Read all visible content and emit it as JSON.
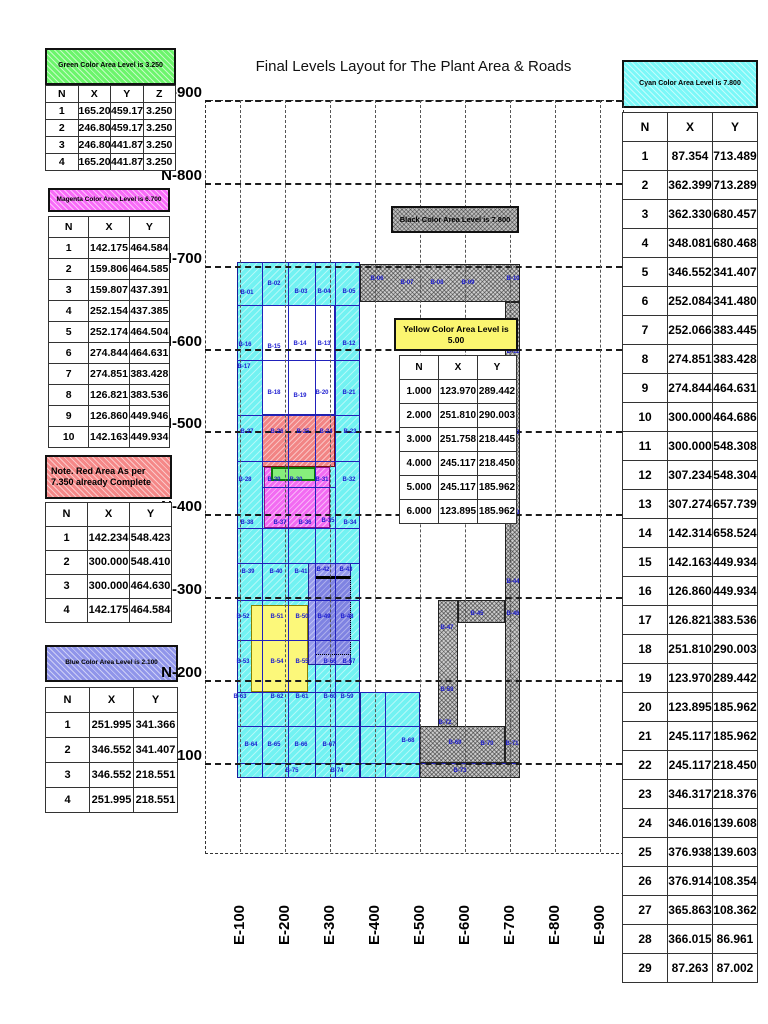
{
  "title": "Final Levels Layout for The Plant Area & Roads",
  "colors": {
    "cyan": "#7bf8f8",
    "green": "#6cf56c",
    "magenta": "#f86bf8",
    "red": "#f58888",
    "blue": "#9095ea",
    "yellow": "#fbf670",
    "hatch_gray": "#cccccc",
    "figure_line_blue": "#2121bb"
  },
  "left_panel": {
    "green": {
      "header": "Green Color Area Level is 3.250",
      "columns": [
        "N",
        "X",
        "Y",
        "Z"
      ],
      "rows": [
        [
          "1",
          "165.201",
          "459.177",
          "3.250"
        ],
        [
          "2",
          "246.802",
          "459.178",
          "3.250"
        ],
        [
          "3",
          "246.801",
          "441.878",
          "3.250"
        ],
        [
          "4",
          "165.202",
          "441.876",
          "3.250"
        ]
      ]
    },
    "magenta": {
      "header": "Magenta Color Area Level is 6.700",
      "columns": [
        "N",
        "X",
        "Y"
      ],
      "rows": [
        [
          "1",
          "142.175",
          "464.584"
        ],
        [
          "2",
          "159.806",
          "464.585"
        ],
        [
          "3",
          "159.807",
          "437.391"
        ],
        [
          "4",
          "252.154",
          "437.385"
        ],
        [
          "5",
          "252.174",
          "464.504"
        ],
        [
          "6",
          "274.844",
          "464.631"
        ],
        [
          "7",
          "274.851",
          "383.428"
        ],
        [
          "8",
          "126.821",
          "383.536"
        ],
        [
          "9",
          "126.860",
          "449.946"
        ],
        [
          "10",
          "142.163",
          "449.934"
        ]
      ]
    },
    "red": {
      "header_line1": "Note. Red Area As per",
      "header_line2": "7.350 already Complete",
      "columns": [
        "N",
        "X",
        "Y"
      ],
      "rows": [
        [
          "1",
          "142.234",
          "548.423"
        ],
        [
          "2",
          "300.000",
          "548.410"
        ],
        [
          "3",
          "300.000",
          "464.630"
        ],
        [
          "4",
          "142.175",
          "464.584"
        ]
      ]
    },
    "blue": {
      "header": "Blue Color Area Level is 2.100",
      "columns": [
        "N",
        "X",
        "Y"
      ],
      "rows": [
        [
          "1",
          "251.995",
          "341.366"
        ],
        [
          "2",
          "346.552",
          "341.407"
        ],
        [
          "3",
          "346.552",
          "218.551"
        ],
        [
          "4",
          "251.995",
          "218.551"
        ]
      ]
    }
  },
  "right_panel": {
    "cyan": {
      "header": "Cyan Color Area Level is 7.800",
      "columns": [
        "N",
        "X",
        "Y"
      ],
      "rows": [
        [
          "1",
          "87.354",
          "713.489"
        ],
        [
          "2",
          "362.399",
          "713.289"
        ],
        [
          "3",
          "362.330",
          "680.457"
        ],
        [
          "4",
          "348.081",
          "680.468"
        ],
        [
          "5",
          "346.552",
          "341.407"
        ],
        [
          "6",
          "252.084",
          "341.480"
        ],
        [
          "7",
          "252.066",
          "383.445"
        ],
        [
          "8",
          "274.851",
          "383.428"
        ],
        [
          "9",
          "274.844",
          "464.631"
        ],
        [
          "10",
          "300.000",
          "464.686"
        ],
        [
          "11",
          "300.000",
          "548.308"
        ],
        [
          "12",
          "307.234",
          "548.304"
        ],
        [
          "13",
          "307.274",
          "657.739"
        ],
        [
          "14",
          "142.314",
          "658.524"
        ],
        [
          "15",
          "142.163",
          "449.934"
        ],
        [
          "16",
          "126.860",
          "449.934"
        ],
        [
          "17",
          "126.821",
          "383.536"
        ],
        [
          "18",
          "251.810",
          "290.003"
        ],
        [
          "19",
          "123.970",
          "289.442"
        ],
        [
          "20",
          "123.895",
          "185.962"
        ],
        [
          "21",
          "245.117",
          "185.962"
        ],
        [
          "22",
          "245.117",
          "218.450"
        ],
        [
          "23",
          "346.317",
          "218.376"
        ],
        [
          "24",
          "346.016",
          "139.608"
        ],
        [
          "25",
          "376.938",
          "139.603"
        ],
        [
          "26",
          "376.914",
          "108.354"
        ],
        [
          "27",
          "365.863",
          "108.362"
        ],
        [
          "28",
          "366.015",
          "86.961"
        ],
        [
          "29",
          "87.263",
          "87.002"
        ]
      ]
    }
  },
  "plot": {
    "black_label": "Black Color Area Level is 7.800",
    "yellow_legend": {
      "header": "Yellow Color Area Level is 5.00",
      "columns": [
        "N",
        "X",
        "Y"
      ],
      "rows": [
        [
          "1.000",
          "123.970",
          "289.442"
        ],
        [
          "2.000",
          "251.810",
          "290.003"
        ],
        [
          "3.000",
          "251.758",
          "218.445"
        ],
        [
          "4.000",
          "245.117",
          "218.450"
        ],
        [
          "5.000",
          "245.117",
          "185.962"
        ],
        [
          "6.000",
          "123.895",
          "185.962"
        ]
      ]
    },
    "n_lines": [
      {
        "label": "N-900",
        "y": 100
      },
      {
        "label": "N-800",
        "y": 183
      },
      {
        "label": "N-700",
        "y": 266
      },
      {
        "label": "N-600",
        "y": 349
      },
      {
        "label": "N-500",
        "y": 431
      },
      {
        "label": "N-400",
        "y": 514
      },
      {
        "label": "N-300",
        "y": 597
      },
      {
        "label": "N-200",
        "y": 680
      },
      {
        "label": "N-100",
        "y": 763
      }
    ],
    "e_lines": [
      {
        "label": "E-100",
        "x": 240
      },
      {
        "label": "E-200",
        "x": 285
      },
      {
        "label": "E-300",
        "x": 330
      },
      {
        "label": "E-400",
        "x": 375
      },
      {
        "label": "E-500",
        "x": 420
      },
      {
        "label": "E-600",
        "x": 465
      },
      {
        "label": "E-700",
        "x": 510
      },
      {
        "label": "E-800",
        "x": 555
      },
      {
        "label": "E-900",
        "x": 600
      }
    ]
  },
  "figure": {
    "regions": [
      {
        "name": "cyan-main",
        "fill": "cyan",
        "x": 237,
        "y": 262,
        "w": 123,
        "h": 516
      },
      {
        "name": "cyan-bottom-extension",
        "fill": "cyan",
        "x": 360,
        "y": 692,
        "w": 60,
        "h": 86
      },
      {
        "name": "white-interior",
        "fill": "white",
        "x": 262,
        "y": 305,
        "w": 73,
        "h": 110
      },
      {
        "name": "red-area",
        "fill": "red",
        "x": 262,
        "y": 415,
        "w": 73,
        "h": 52
      },
      {
        "name": "magenta-area",
        "fill": "magenta",
        "x": 264,
        "y": 467,
        "w": 66,
        "h": 61
      },
      {
        "name": "green-area",
        "fill": "green",
        "x": 271,
        "y": 467,
        "w": 45,
        "h": 14
      },
      {
        "name": "yellow-area",
        "fill": "yellow",
        "x": 251,
        "y": 605,
        "w": 57,
        "h": 87
      },
      {
        "name": "blue-area",
        "fill": "blue",
        "x": 308,
        "y": 563,
        "w": 43,
        "h": 102
      },
      {
        "name": "blue-inner-box",
        "fill": "blueinner",
        "x": 315,
        "y": 576,
        "w": 36,
        "h": 79
      },
      {
        "name": "hatch-top-band",
        "fill": "hatch",
        "x": 360,
        "y": 264,
        "w": 160,
        "h": 38
      },
      {
        "name": "hatch-right-strip",
        "fill": "hatch",
        "x": 505,
        "y": 302,
        "w": 15,
        "h": 461
      },
      {
        "name": "hatch-mid-strip",
        "fill": "hatch",
        "x": 438,
        "y": 600,
        "w": 20,
        "h": 163
      },
      {
        "name": "hatch-connector",
        "fill": "hatch",
        "x": 458,
        "y": 600,
        "w": 47,
        "h": 23
      },
      {
        "name": "hatch-bottom-cells",
        "fill": "hatch",
        "x": 420,
        "y": 726,
        "w": 85,
        "h": 37
      },
      {
        "name": "hatch-bottom-strip",
        "fill": "hatch",
        "x": 420,
        "y": 763,
        "w": 100,
        "h": 15
      }
    ],
    "vlines": [
      {
        "x": 262,
        "y": 262,
        "len": 516
      },
      {
        "x": 288,
        "y": 262,
        "len": 516
      },
      {
        "x": 315,
        "y": 262,
        "len": 516
      },
      {
        "x": 335,
        "y": 262,
        "len": 516
      },
      {
        "x": 385,
        "y": 692,
        "len": 86
      }
    ],
    "hlines": [
      {
        "y": 305,
        "x": 237,
        "len": 123
      },
      {
        "y": 360,
        "x": 237,
        "len": 123
      },
      {
        "y": 415,
        "x": 237,
        "len": 123
      },
      {
        "y": 461,
        "x": 237,
        "len": 123
      },
      {
        "y": 487,
        "x": 262,
        "len": 73
      },
      {
        "y": 528,
        "x": 237,
        "len": 123
      },
      {
        "y": 563,
        "x": 237,
        "len": 123
      },
      {
        "y": 600,
        "x": 237,
        "len": 123
      },
      {
        "y": 640,
        "x": 237,
        "len": 123
      },
      {
        "y": 692,
        "x": 237,
        "len": 183
      },
      {
        "y": 726,
        "x": 237,
        "len": 183
      },
      {
        "y": 763,
        "x": 237,
        "len": 283
      }
    ],
    "labels": [
      {
        "t": "B-01",
        "x": 247,
        "y": 293
      },
      {
        "t": "B-02",
        "x": 274,
        "y": 284
      },
      {
        "t": "B-03",
        "x": 301,
        "y": 292
      },
      {
        "t": "B-04",
        "x": 324,
        "y": 292
      },
      {
        "t": "B-05",
        "x": 349,
        "y": 292
      },
      {
        "t": "B-06",
        "x": 377,
        "y": 279
      },
      {
        "t": "B-07",
        "x": 407,
        "y": 283
      },
      {
        "t": "B-08",
        "x": 437,
        "y": 283
      },
      {
        "t": "B-09",
        "x": 468,
        "y": 283
      },
      {
        "t": "B-10",
        "x": 513,
        "y": 279
      },
      {
        "t": "B-11",
        "x": 513,
        "y": 352
      },
      {
        "t": "B-12",
        "x": 349,
        "y": 344
      },
      {
        "t": "B-13",
        "x": 324,
        "y": 344
      },
      {
        "t": "B-14",
        "x": 300,
        "y": 344
      },
      {
        "t": "B-15",
        "x": 274,
        "y": 347
      },
      {
        "t": "B-16",
        "x": 245,
        "y": 345
      },
      {
        "t": "B-17",
        "x": 244,
        "y": 367
      },
      {
        "t": "B-18",
        "x": 274,
        "y": 393
      },
      {
        "t": "B-19",
        "x": 300,
        "y": 396
      },
      {
        "t": "B-20",
        "x": 322,
        "y": 393
      },
      {
        "t": "B-21",
        "x": 349,
        "y": 393
      },
      {
        "t": "B-22",
        "x": 513,
        "y": 433
      },
      {
        "t": "B-23",
        "x": 350,
        "y": 432
      },
      {
        "t": "B-24",
        "x": 326,
        "y": 432
      },
      {
        "t": "B-25",
        "x": 303,
        "y": 432
      },
      {
        "t": "B-26",
        "x": 277,
        "y": 432
      },
      {
        "t": "B-27",
        "x": 247,
        "y": 432
      },
      {
        "t": "B-28",
        "x": 245,
        "y": 480
      },
      {
        "t": "B-29",
        "x": 274,
        "y": 480
      },
      {
        "t": "B-30",
        "x": 296,
        "y": 480
      },
      {
        "t": "B-31",
        "x": 322,
        "y": 480
      },
      {
        "t": "B-32",
        "x": 349,
        "y": 480
      },
      {
        "t": "B-33",
        "x": 513,
        "y": 513
      },
      {
        "t": "B-34",
        "x": 350,
        "y": 523
      },
      {
        "t": "B-35",
        "x": 328,
        "y": 521
      },
      {
        "t": "B-36",
        "x": 305,
        "y": 523
      },
      {
        "t": "B-37",
        "x": 280,
        "y": 523
      },
      {
        "t": "B-38",
        "x": 247,
        "y": 523
      },
      {
        "t": "B-39",
        "x": 248,
        "y": 572
      },
      {
        "t": "B-40",
        "x": 276,
        "y": 572
      },
      {
        "t": "B-41",
        "x": 301,
        "y": 572
      },
      {
        "t": "B-42",
        "x": 323,
        "y": 570
      },
      {
        "t": "B-43",
        "x": 346,
        "y": 570
      },
      {
        "t": "B-44",
        "x": 513,
        "y": 582
      },
      {
        "t": "B-45",
        "x": 477,
        "y": 614
      },
      {
        "t": "B-46",
        "x": 513,
        "y": 614
      },
      {
        "t": "B-47",
        "x": 447,
        "y": 628
      },
      {
        "t": "B-48",
        "x": 347,
        "y": 617
      },
      {
        "t": "B-49",
        "x": 324,
        "y": 617
      },
      {
        "t": "B-50",
        "x": 302,
        "y": 617
      },
      {
        "t": "B-51",
        "x": 277,
        "y": 617
      },
      {
        "t": "B-52",
        "x": 243,
        "y": 617
      },
      {
        "t": "B-53",
        "x": 243,
        "y": 662
      },
      {
        "t": "B-54",
        "x": 277,
        "y": 662
      },
      {
        "t": "B-55",
        "x": 302,
        "y": 662
      },
      {
        "t": "B-56",
        "x": 330,
        "y": 662
      },
      {
        "t": "B-57",
        "x": 349,
        "y": 662
      },
      {
        "t": "B-58",
        "x": 447,
        "y": 690
      },
      {
        "t": "B-59",
        "x": 347,
        "y": 697
      },
      {
        "t": "B-60",
        "x": 330,
        "y": 697
      },
      {
        "t": "B-61",
        "x": 302,
        "y": 697
      },
      {
        "t": "B-62",
        "x": 277,
        "y": 697
      },
      {
        "t": "B-63",
        "x": 240,
        "y": 697
      },
      {
        "t": "B-64",
        "x": 251,
        "y": 745
      },
      {
        "t": "B-65",
        "x": 274,
        "y": 745
      },
      {
        "t": "B-66",
        "x": 301,
        "y": 745
      },
      {
        "t": "B-67",
        "x": 329,
        "y": 745
      },
      {
        "t": "B-68",
        "x": 408,
        "y": 741
      },
      {
        "t": "B-69",
        "x": 455,
        "y": 743
      },
      {
        "t": "B-70",
        "x": 487,
        "y": 744
      },
      {
        "t": "B-71",
        "x": 512,
        "y": 744
      },
      {
        "t": "B-72",
        "x": 445,
        "y": 723
      },
      {
        "t": "B-73",
        "x": 460,
        "y": 771
      },
      {
        "t": "B-74",
        "x": 337,
        "y": 771
      },
      {
        "t": "B-75",
        "x": 292,
        "y": 771
      }
    ]
  }
}
